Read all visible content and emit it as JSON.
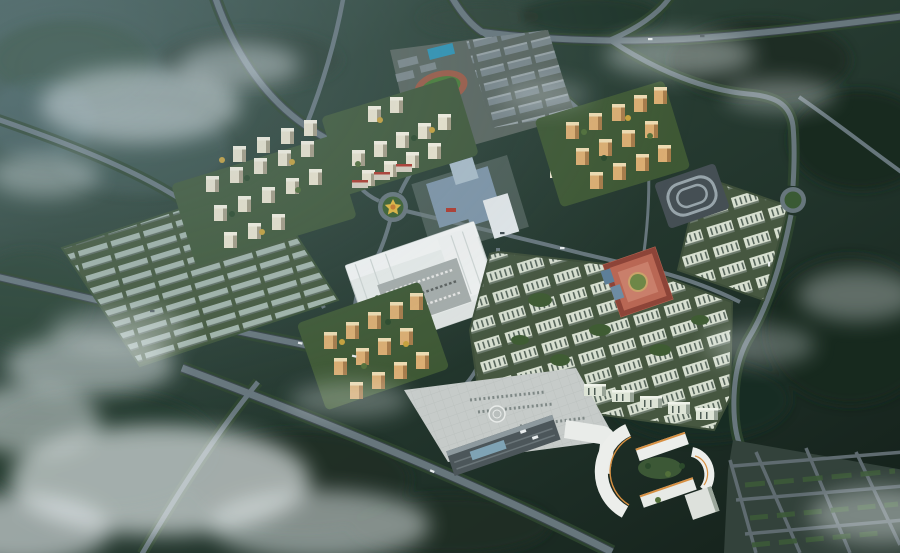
{
  "meta": {
    "type": "aerial architectural rendering",
    "subject": "Bird's-eye master-plan rendering of a mixed-use residential community surrounded by dark forested hills and low drifting mist",
    "view": "oblique aerial, dusk overcast lighting",
    "width_px": 900,
    "height_px": 553
  },
  "palette": {
    "forest_light": "#3b5347",
    "forest_mid": "#26392f",
    "forest_dark": "#141f1a",
    "mist_white": "#e9eff1",
    "haze_blue": "#8ca5b4",
    "road_surface": "#67767c",
    "road_casing": "#39444a",
    "road_treeline": "#2d452f",
    "residential_cream": "#ece5cf",
    "residential_orange": "#dcae72",
    "slab_pale": "#d7dfd0",
    "campus_gray": "#79868a",
    "glass_blue": "#7e95a8",
    "mall_roof": "#e8ecea",
    "parking_gray": "#a6adab",
    "plaza_paving": "#c6cbc9",
    "terminal_roof": "#4c565a",
    "red_plaza": "#b96754",
    "track_red": "#9c5b46",
    "field_green": "#487d37",
    "pool_blue": "#2e93b4",
    "lawn_green": "#40593a",
    "tree_dark": "#2c4a2c",
    "tree_yellow": "#c8a23c",
    "office_white": "#eceeeb",
    "office_orange_trim": "#d79042"
  },
  "scene": {
    "districts": [
      {
        "id": "lowrise-grid",
        "label": "low-rise row-housing grid (west)"
      },
      {
        "id": "west-residential",
        "label": "cream high-rise residential cluster",
        "towers": 17
      },
      {
        "id": "north-residential",
        "label": "cream residential cluster beside school",
        "towers": 12
      },
      {
        "id": "school-campus",
        "label": "campus with running track, blue courts and classroom rows"
      },
      {
        "id": "northeast-residential",
        "label": "orange residential tower cluster",
        "towers": 14
      },
      {
        "id": "central-commercial",
        "label": "blue glass commercial complex"
      },
      {
        "id": "shopping-mall",
        "label": "white shopping mall with central parking court"
      },
      {
        "id": "slab-district",
        "label": "pale mid-rise slab housing estate (east)"
      },
      {
        "id": "red-plaza",
        "label": "red-paved neighborhood commercial plaza"
      },
      {
        "id": "bus-depot",
        "label": "depot with looping lanes"
      },
      {
        "id": "southwest-residential",
        "label": "orange residential tower cluster",
        "towers": 13
      },
      {
        "id": "transit-terminal",
        "label": "transport terminal with gabled roofs and paved apron"
      },
      {
        "id": "office-park",
        "label": "curved white office blocks with orange trim"
      },
      {
        "id": "southeast-parcels",
        "label": "hedged development parcels with road grid"
      }
    ],
    "landmarks": [
      {
        "id": "central-roundabout",
        "label": "roundabout with yellow star flowerbed"
      },
      {
        "id": "east-roundabout",
        "label": "eastern roundabout"
      },
      {
        "id": "running-track",
        "label": "athletics track with green infield"
      },
      {
        "id": "helipad-circle",
        "label": "circular marking on terminal apron"
      }
    ],
    "environment": {
      "forest": "dense dark-green woodland on all sides",
      "clouds": "white mist patches, heaviest in bottom-left corner",
      "roads": "tree-lined arterials, peripheral ring road, two roundabouts"
    }
  }
}
